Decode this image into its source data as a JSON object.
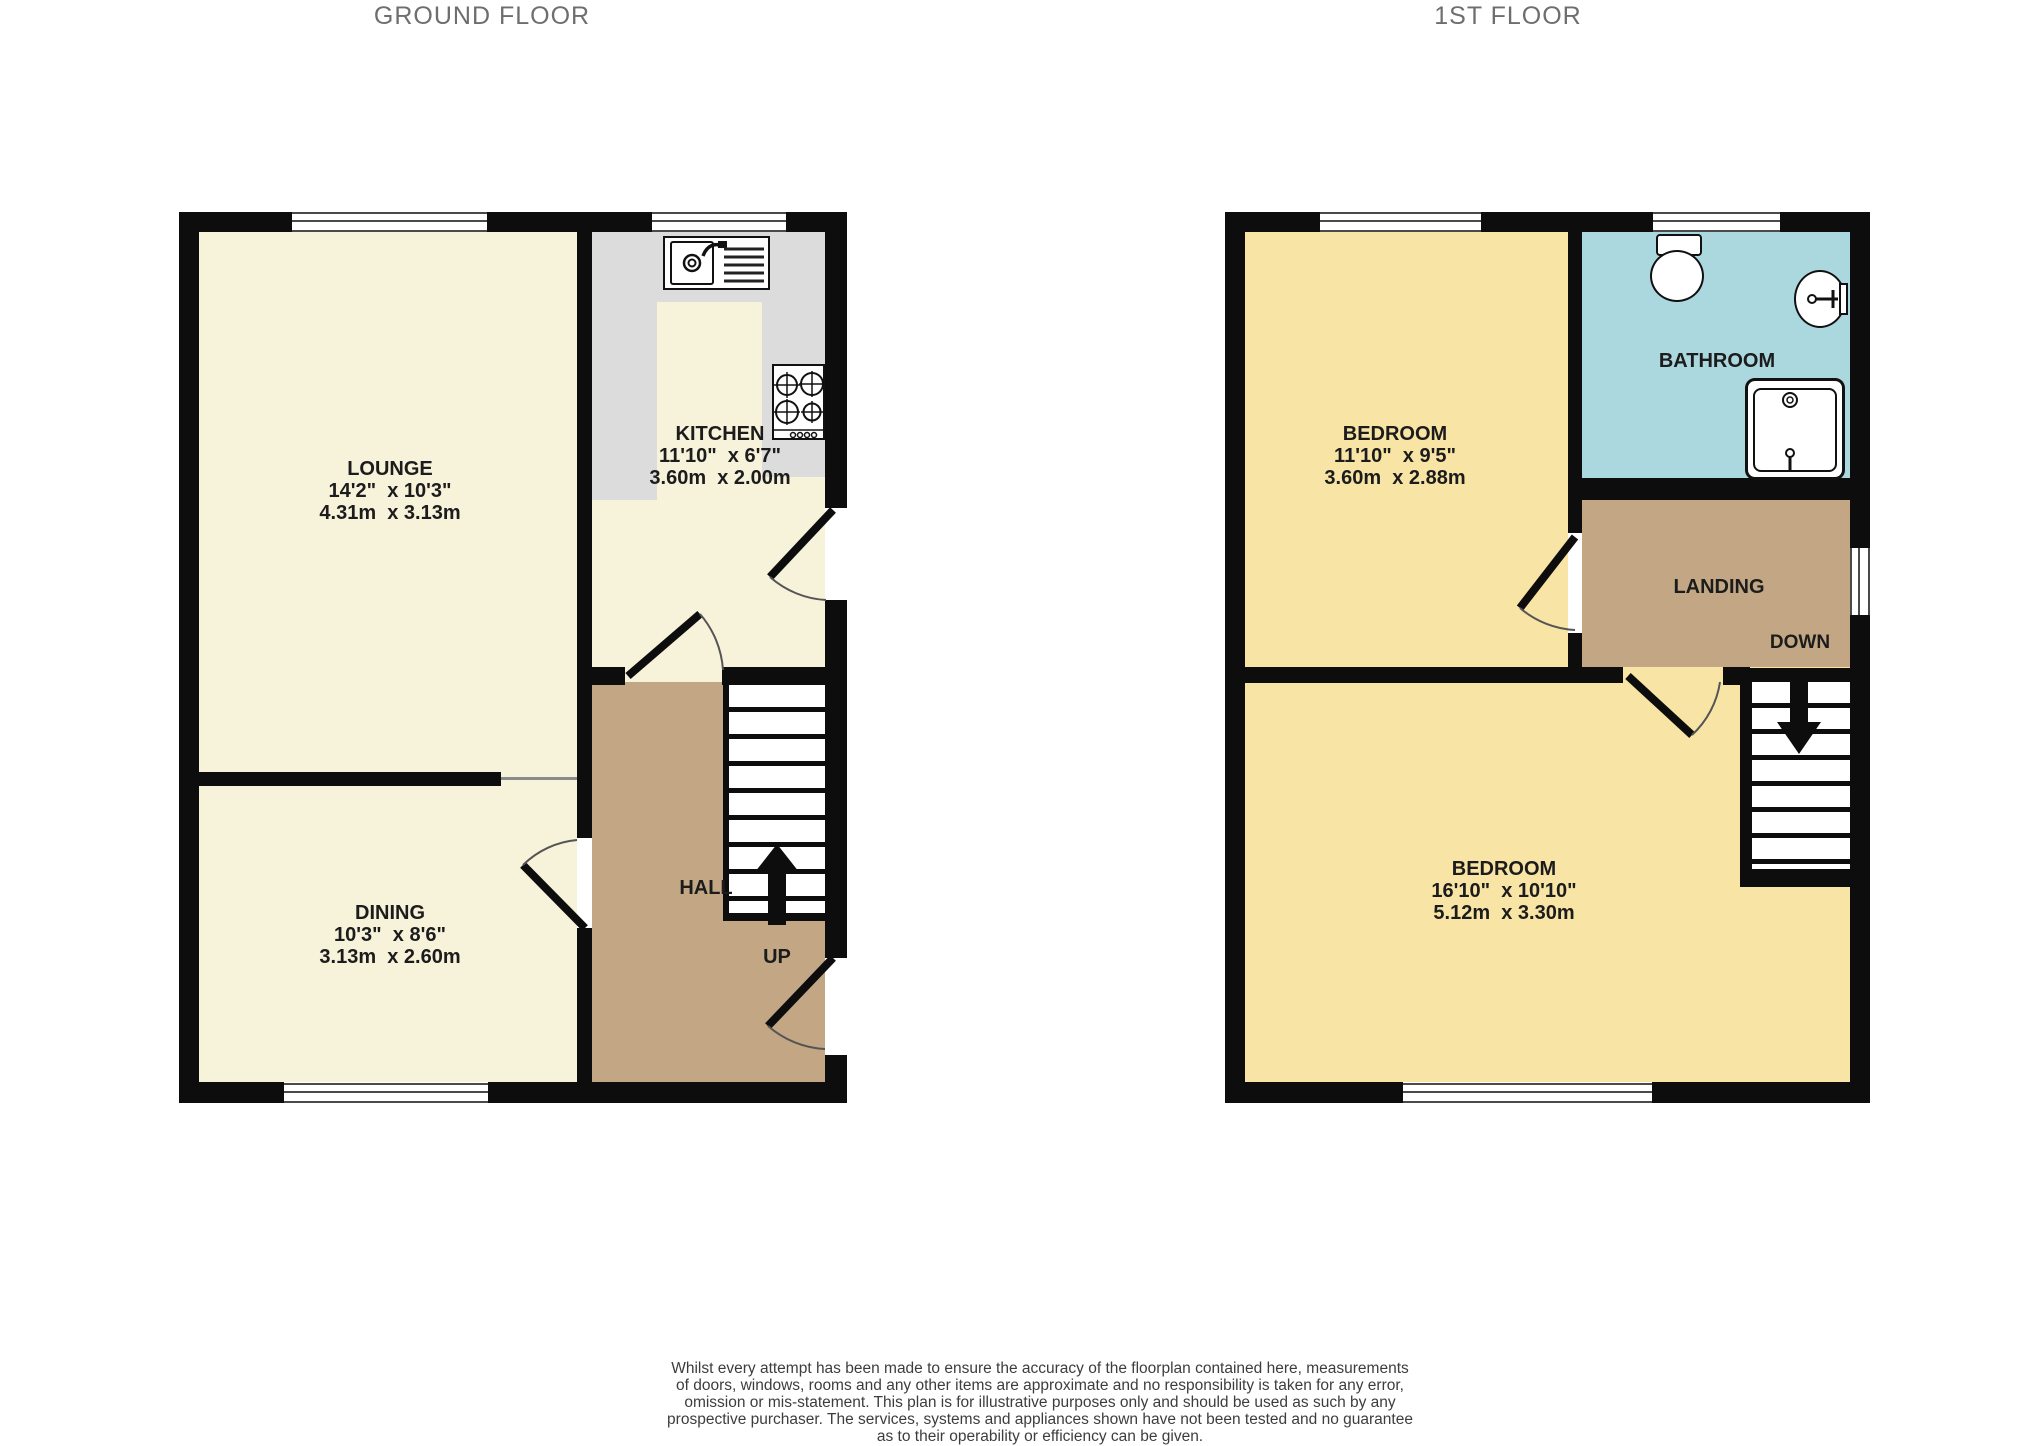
{
  "titles": {
    "ground_floor": "GROUND FLOOR",
    "first_floor": "1ST FLOOR"
  },
  "ground": {
    "lounge": {
      "name": "LOUNGE",
      "imperial": "14'2\"  x 10'3\"",
      "metric": "4.31m  x 3.13m"
    },
    "kitchen": {
      "name": "KITCHEN",
      "imperial": "11'10\"  x 6'7\"",
      "metric": "3.60m  x 2.00m"
    },
    "dining": {
      "name": "DINING",
      "imperial": "10'3\"  x 8'6\"",
      "metric": "3.13m  x 2.60m"
    },
    "hall": {
      "name": "HALL"
    },
    "stairs_label": "UP"
  },
  "first": {
    "bedroom1": {
      "name": "BEDROOM",
      "imperial": "11'10\"  x 9'5\"",
      "metric": "3.60m  x 2.88m"
    },
    "bathroom": {
      "name": "BATHROOM"
    },
    "landing": {
      "name": "LANDING"
    },
    "stairs_label": "DOWN",
    "bedroom2": {
      "name": "BEDROOM",
      "imperial": "16'10\"  x 10'10\"",
      "metric": "5.12m  x 3.30m"
    }
  },
  "footer": {
    "lines": [
      "Whilst every attempt has been made to ensure the accuracy of the floorplan contained here, measurements",
      "of doors, windows, rooms and any other items are approximate and no responsibility is taken for any error,",
      "omission or mis-statement. This plan is for illustrative purposes only and should be used as such by any",
      "prospective purchaser. The services, systems and appliances shown have not been tested and no guarantee",
      "as to their operability or efficiency can be given.",
      "Made with Metropix ©2025"
    ]
  },
  "colors": {
    "wall": "#0d0d0d",
    "cream": "#f7f2da",
    "counter": "#dcdcdc",
    "brown": "#c3a784",
    "yellow": "#f8e5a6",
    "blue": "#abd7de",
    "title_gray": "#6e6e6e",
    "text_dark": "#1c1c1c",
    "footer_gray": "#3d3d3d",
    "window_line": "#4a4a4a",
    "thin_divider": "#8a8a8a",
    "arc": "#555555"
  }
}
